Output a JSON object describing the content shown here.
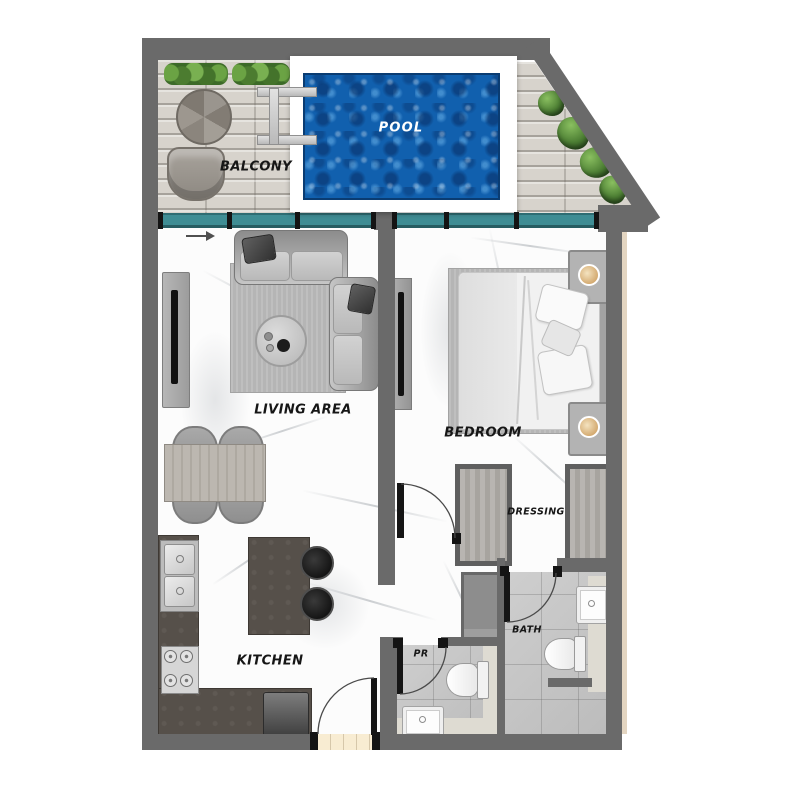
{
  "labels": {
    "balcony": "BALCONY",
    "pool": "POOL",
    "living_area": "LIVING AREA",
    "bedroom": "BEDROOM",
    "dressing": "DRESSING",
    "bath": "BATH",
    "powder_room": "PR",
    "kitchen": "KITCHEN"
  },
  "colors": {
    "wall": "#6a6a6a",
    "pool_water": "#1160ae",
    "pool_water_dark": "#0a3c72",
    "window_glass": "#3f8d94",
    "deck_wood": "#d7d3cc",
    "marble_floor": "#fcfcfc",
    "counter_dark": "#56504a",
    "tile_gray": "#c6c6c6",
    "speckle_border": "#dedbd2",
    "plant_green": "#4d7f34",
    "lamp_tan": "#d9b482",
    "threshold_beige": "#f8ecd2",
    "rug_gray": "#b5b5b5"
  },
  "rooms": [
    "balcony",
    "pool",
    "living_area",
    "bedroom",
    "dressing",
    "bath",
    "powder_room",
    "kitchen"
  ]
}
